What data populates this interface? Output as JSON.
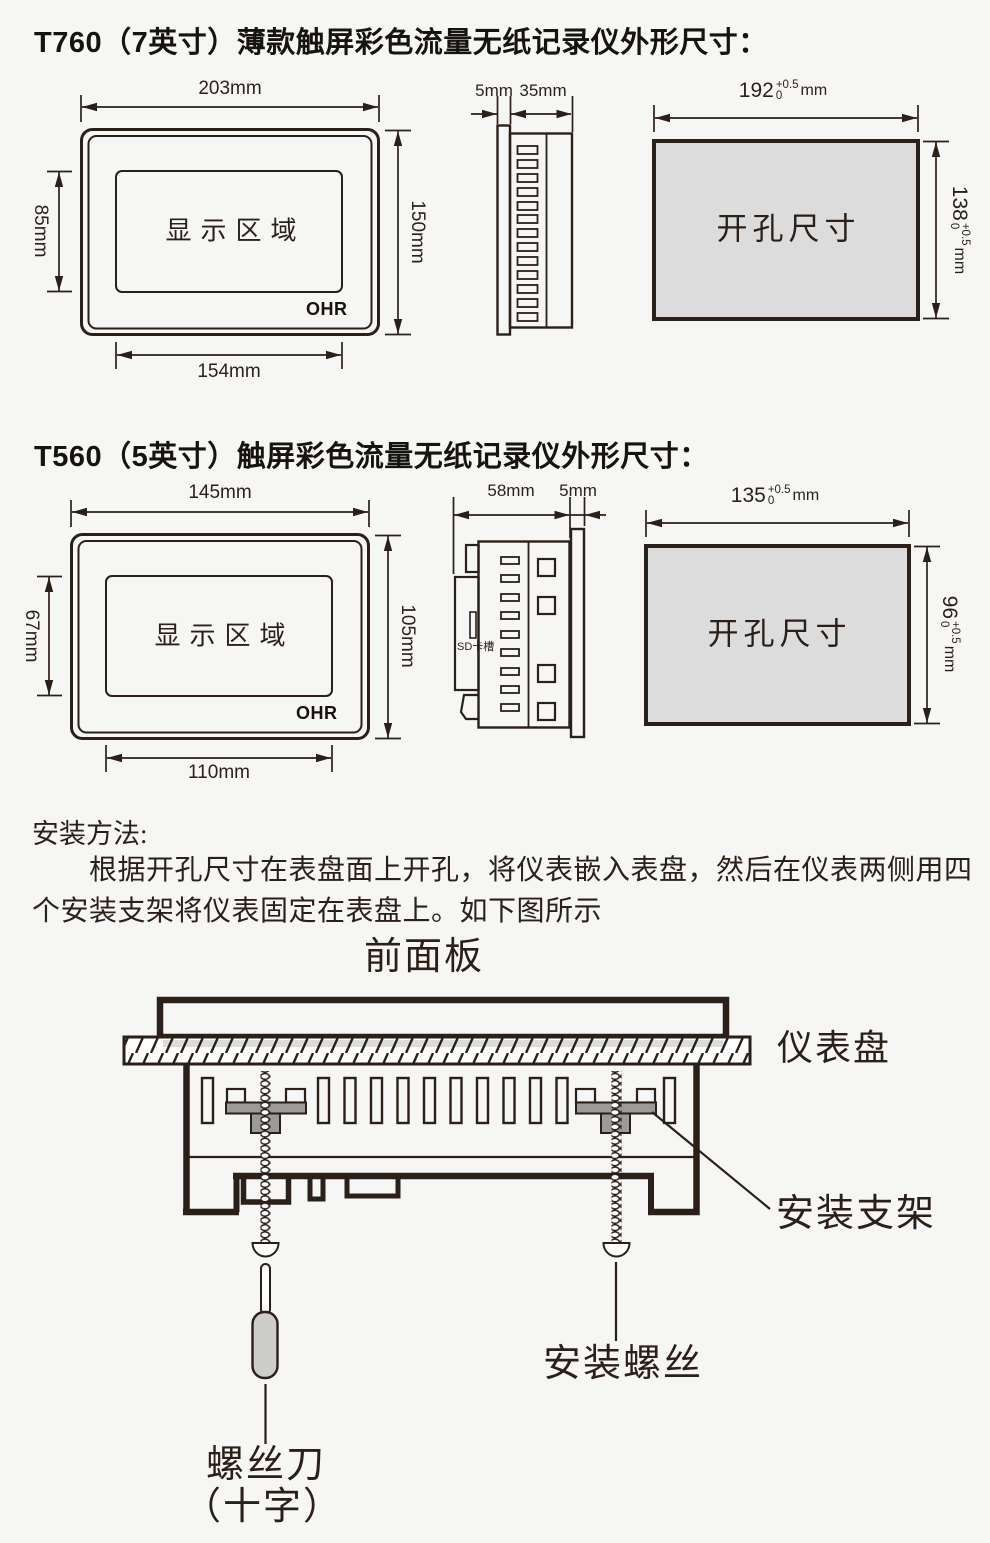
{
  "page": {
    "background": "#f6f6f4",
    "ink": "#2b1f1a",
    "cutout_fill": "#dcdcdc",
    "bracket_gray": "#9b9b9b",
    "handle_gray": "#cdcdca"
  },
  "t760": {
    "title": "T760（7英寸）薄款触屏彩色流量无纸记录仪外形尺寸：",
    "front": {
      "top_dim": "203mm",
      "left_dim": "85mm",
      "right_dim": "150mm",
      "bottom_dim": "154mm",
      "display_label": "显示区域",
      "logo": "OHR"
    },
    "side": {
      "flange_dim": "5mm",
      "depth_dim": "35mm"
    },
    "cutout": {
      "label": "开孔尺寸",
      "width": {
        "value": "192",
        "plus": "+0.5",
        "minus": "0",
        "unit": "mm"
      },
      "height": {
        "value": "138",
        "plus": "+0.5",
        "minus": "0",
        "unit": "mm"
      }
    }
  },
  "t560": {
    "title": "T560（5英寸）触屏彩色流量无纸记录仪外形尺寸：",
    "front": {
      "top_dim": "145mm",
      "left_dim": "67mm",
      "right_dim": "105mm",
      "bottom_dim": "110mm",
      "display_label": "显示区域",
      "logo": "OHR"
    },
    "side": {
      "depth_dim": "58mm",
      "flange_dim": "5mm",
      "sd_label": "SD卡槽"
    },
    "cutout": {
      "label": "开孔尺寸",
      "width": {
        "value": "135",
        "plus": "+0.5",
        "minus": "0",
        "unit": "mm"
      },
      "height": {
        "value": "96",
        "plus": "+0.5",
        "minus": "0",
        "unit": "mm"
      }
    }
  },
  "install": {
    "heading": "安装方法:",
    "para_line1": "　　根据开孔尺寸在表盘面上开孔，将仪表嵌入表盘，然后在仪表两侧用四",
    "para_line2": "个安装支架将仪表固定在表盘上。如下图所示",
    "labels": {
      "front_panel": "前面板",
      "panel": "仪表盘",
      "bracket": "安装支架",
      "screw": "安装螺丝",
      "screwdriver": "螺丝刀",
      "screwdriver2": "（十字）"
    }
  }
}
